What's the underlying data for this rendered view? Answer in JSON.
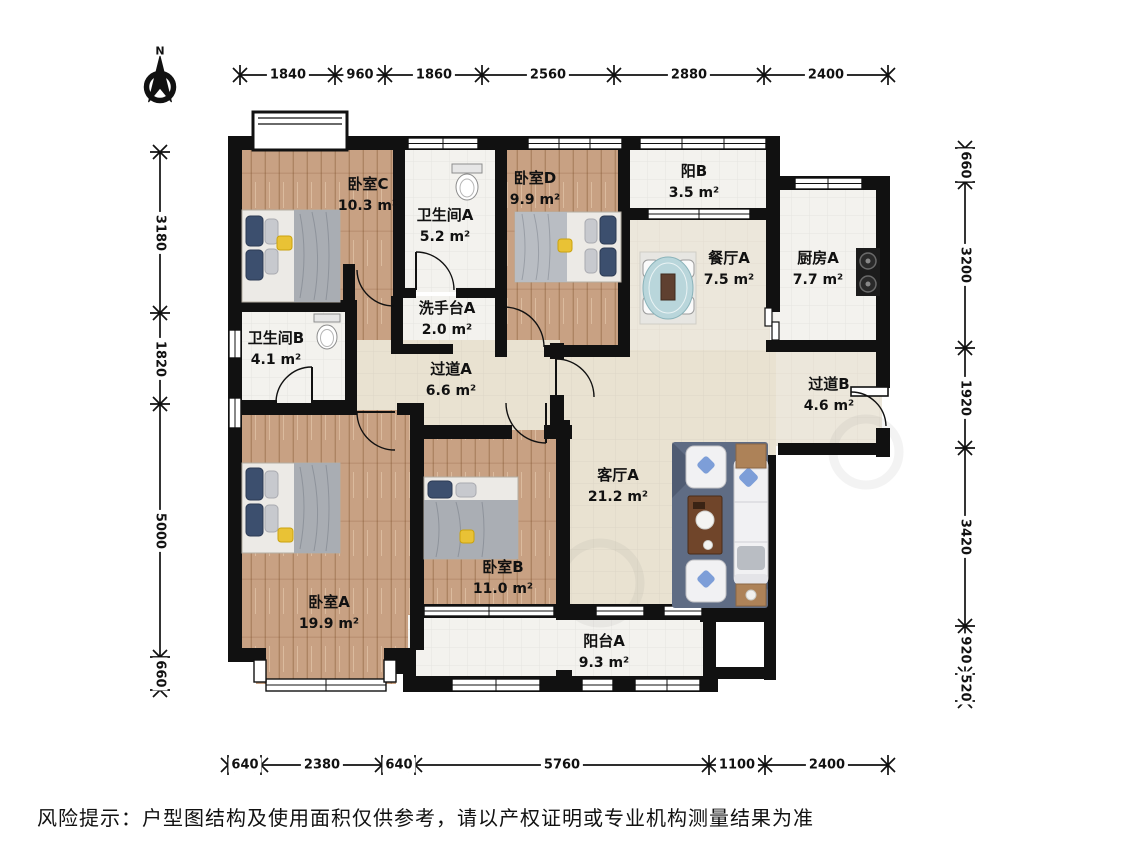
{
  "compass": {
    "north_label": "N"
  },
  "rooms": [
    {
      "id": "bedroom-c",
      "name": "卧室C",
      "area": "10.3 m²"
    },
    {
      "id": "bath-a",
      "name": "卫生间A",
      "area": "5.2 m²"
    },
    {
      "id": "bedroom-d",
      "name": "卧室D",
      "area": "9.9 m²"
    },
    {
      "id": "balcony-b",
      "name": "阳B",
      "area": "3.5 m²"
    },
    {
      "id": "dining-a",
      "name": "餐厅A",
      "area": "7.5 m²"
    },
    {
      "id": "kitchen-a",
      "name": "厨房A",
      "area": "7.7 m²"
    },
    {
      "id": "wash-a",
      "name": "洗手台A",
      "area": "2.0 m²"
    },
    {
      "id": "bath-b",
      "name": "卫生间B",
      "area": "4.1 m²"
    },
    {
      "id": "hallway-a",
      "name": "过道A",
      "area": "6.6 m²"
    },
    {
      "id": "hallway-b",
      "name": "过道B",
      "area": "4.6 m²"
    },
    {
      "id": "living-a",
      "name": "客厅A",
      "area": "21.2 m²"
    },
    {
      "id": "bedroom-a",
      "name": "卧室A",
      "area": "19.9 m²"
    },
    {
      "id": "bedroom-b",
      "name": "卧室B",
      "area": "11.0 m²"
    },
    {
      "id": "balcony-a",
      "name": "阳台A",
      "area": "9.3 m²"
    }
  ],
  "dimensions": {
    "top": [
      "1840",
      "960",
      "1860",
      "2560",
      "2880",
      "2400"
    ],
    "bottom": [
      "640",
      "2380",
      "640",
      "5760",
      "1100",
      "2400"
    ],
    "left": [
      "3180",
      "1820",
      "5000",
      "660"
    ],
    "right": [
      "660",
      "3200",
      "1920",
      "3420",
      "920",
      "520"
    ]
  },
  "disclaimer": "风险提示：户型图结构及使用面积仅供参考，请以产权证明或专业机构测量结果为准",
  "colors": {
    "wall": "#111111",
    "wood_floor": "#c8a183",
    "tile_floor": "#f3f2ee",
    "warm_floor": "#e9e2d1",
    "rug": "#5f6c84",
    "pillow_navy": "#3c4f6e",
    "accent_yellow": "#e9c235",
    "table_teal": "#b9d6db"
  }
}
